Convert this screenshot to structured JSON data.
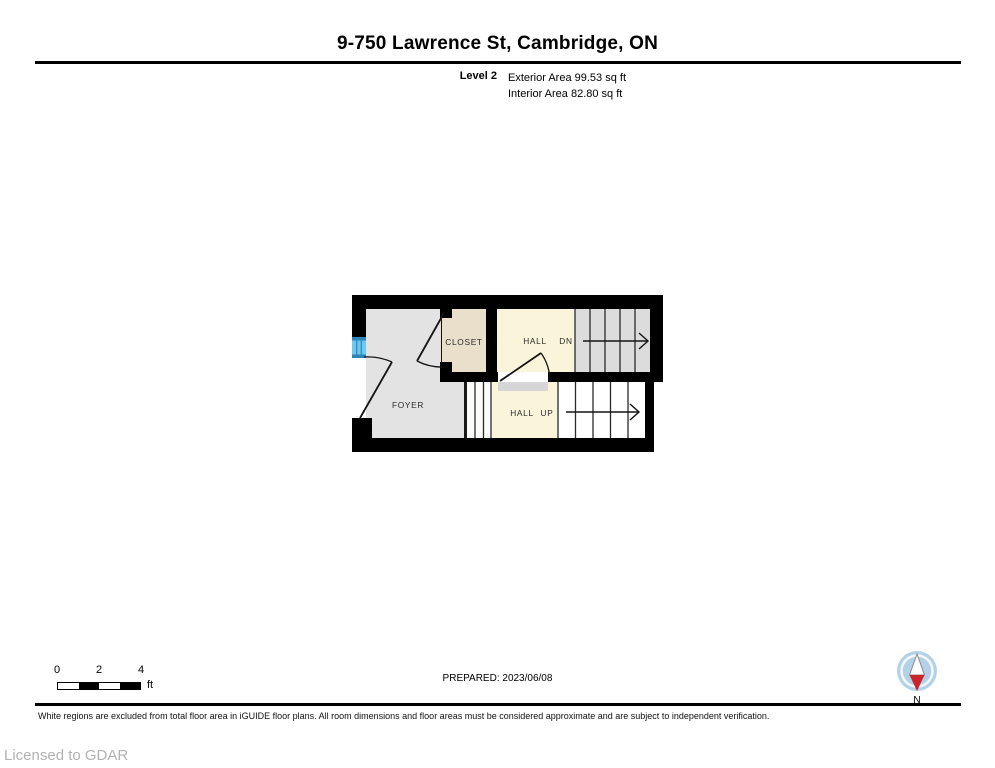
{
  "header": {
    "title": "9-750 Lawrence St, Cambridge, ON",
    "level_label": "Level 2",
    "exterior_area": "Exterior Area 99.53 sq ft",
    "interior_area": "Interior Area 82.80 sq ft"
  },
  "floor_plan": {
    "rooms": {
      "closet": "CLOSET",
      "hall_upper": "HALL",
      "hall_upper_dir": "DN",
      "foyer": "FOYER",
      "hall_lower": "HALL",
      "hall_lower_dir": "UP"
    },
    "colors": {
      "wall": "#000000",
      "foyer_fill": "#e3e3e3",
      "closet_fill": "#e9dfca",
      "hall_fill": "#faf5da",
      "stairs_upper_fill": "#dcdcdc",
      "stairs_lower_fill": "#ffffff",
      "threshold_fill": "#d6d6d6",
      "window_blue_light": "#6ec9f0",
      "window_blue_dark": "#2e86b8",
      "compass_blue": "#b3d2e8",
      "compass_red": "#c9252b"
    }
  },
  "footer": {
    "scale": {
      "tick0": "0",
      "tick2": "2",
      "tick4": "4",
      "unit": "ft"
    },
    "prepared": "PREPARED: 2023/06/08",
    "compass_label": "N",
    "disclaimer": "White regions are excluded from total floor area in iGUIDE floor plans. All room dimensions and floor areas must be considered approximate and are subject to independent verification.",
    "license": "Licensed to GDAR"
  }
}
